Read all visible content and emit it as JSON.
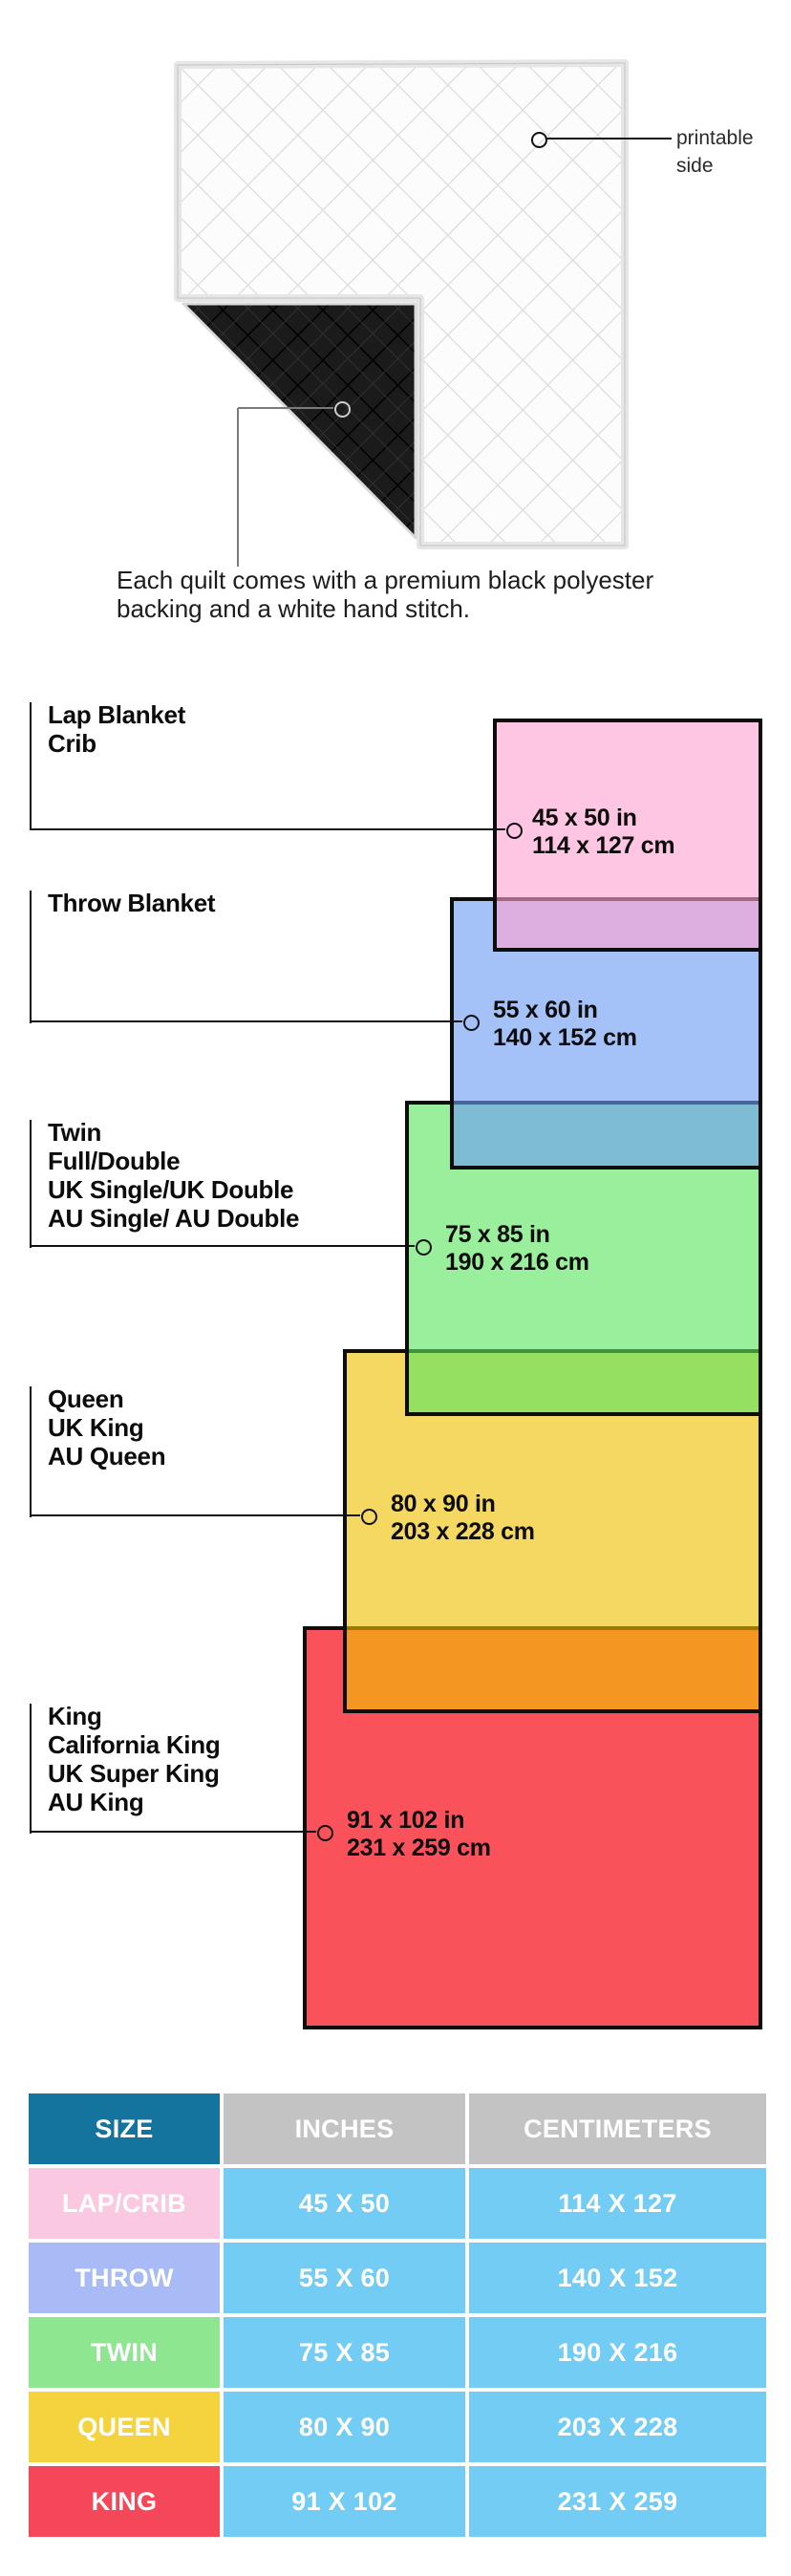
{
  "quilt": {
    "printable_side_label": "printable side",
    "backing_note": "Each quilt comes with a premium black polyester backing and a white hand stitch."
  },
  "diagram": {
    "sizes": [
      {
        "id": "lap-crib",
        "labels": [
          "Lap Blanket",
          "Crib"
        ],
        "inches": "45 x 50 in",
        "centimeters": "114 x 127 cm",
        "color": "#FFC6E3",
        "fill": "rgba(255,163,210,0.62)"
      },
      {
        "id": "throw",
        "labels": [
          "Throw Blanket"
        ],
        "inches": "55 x 60 in",
        "centimeters": "140 x 152 cm",
        "color": "#A4C2F8",
        "fill": "rgba(108,157,244,0.62)"
      },
      {
        "id": "twin",
        "labels": [
          "Twin",
          "Full/Double",
          "UK Single/UK Double",
          "AU Single/ AU Double"
        ],
        "inches": "75 x 85 in",
        "centimeters": "190 x 216 cm",
        "color": "#9AEF9D",
        "fill": "rgba(92,229,97,0.62)"
      },
      {
        "id": "queen",
        "labels": [
          "Queen",
          "UK King",
          "AU Queen"
        ],
        "inches": "80 x 90 in",
        "centimeters": "203 x 228 cm",
        "color": "#F2DC4C",
        "fill": "rgba(239,192,0,0.62)"
      },
      {
        "id": "king",
        "labels": [
          "King",
          "California King",
          "UK Super King",
          "AU King"
        ],
        "inches": "91 x 102 in",
        "centimeters": "231 x 259 cm",
        "color": "#F4475A",
        "fill": "rgba(246,0,12,0.68)"
      }
    ]
  },
  "table": {
    "headers": [
      "SIZE",
      "INCHES",
      "CENTIMETERS"
    ],
    "header_colors": {
      "size": "#15749E",
      "measure": "#C3C3C3"
    },
    "value_cell_color": "#73CCF3",
    "rows": [
      {
        "size": "LAP/CRIB",
        "inches": "45 X 50",
        "centimeters": "114 X 127",
        "color": "#FBC8E1"
      },
      {
        "size": "THROW",
        "inches": "55 X 60",
        "centimeters": "140 X 152",
        "color": "#A9BBF7"
      },
      {
        "size": "TWIN",
        "inches": "75 X 85",
        "centimeters": "190 X 216",
        "color": "#8FE690"
      },
      {
        "size": "QUEEN",
        "inches": "80 X 90",
        "centimeters": "203 X 228",
        "color": "#F5D33F"
      },
      {
        "size": "KING",
        "inches": "91 X 102",
        "centimeters": "231 X 259",
        "color": "#F4475A"
      }
    ]
  }
}
